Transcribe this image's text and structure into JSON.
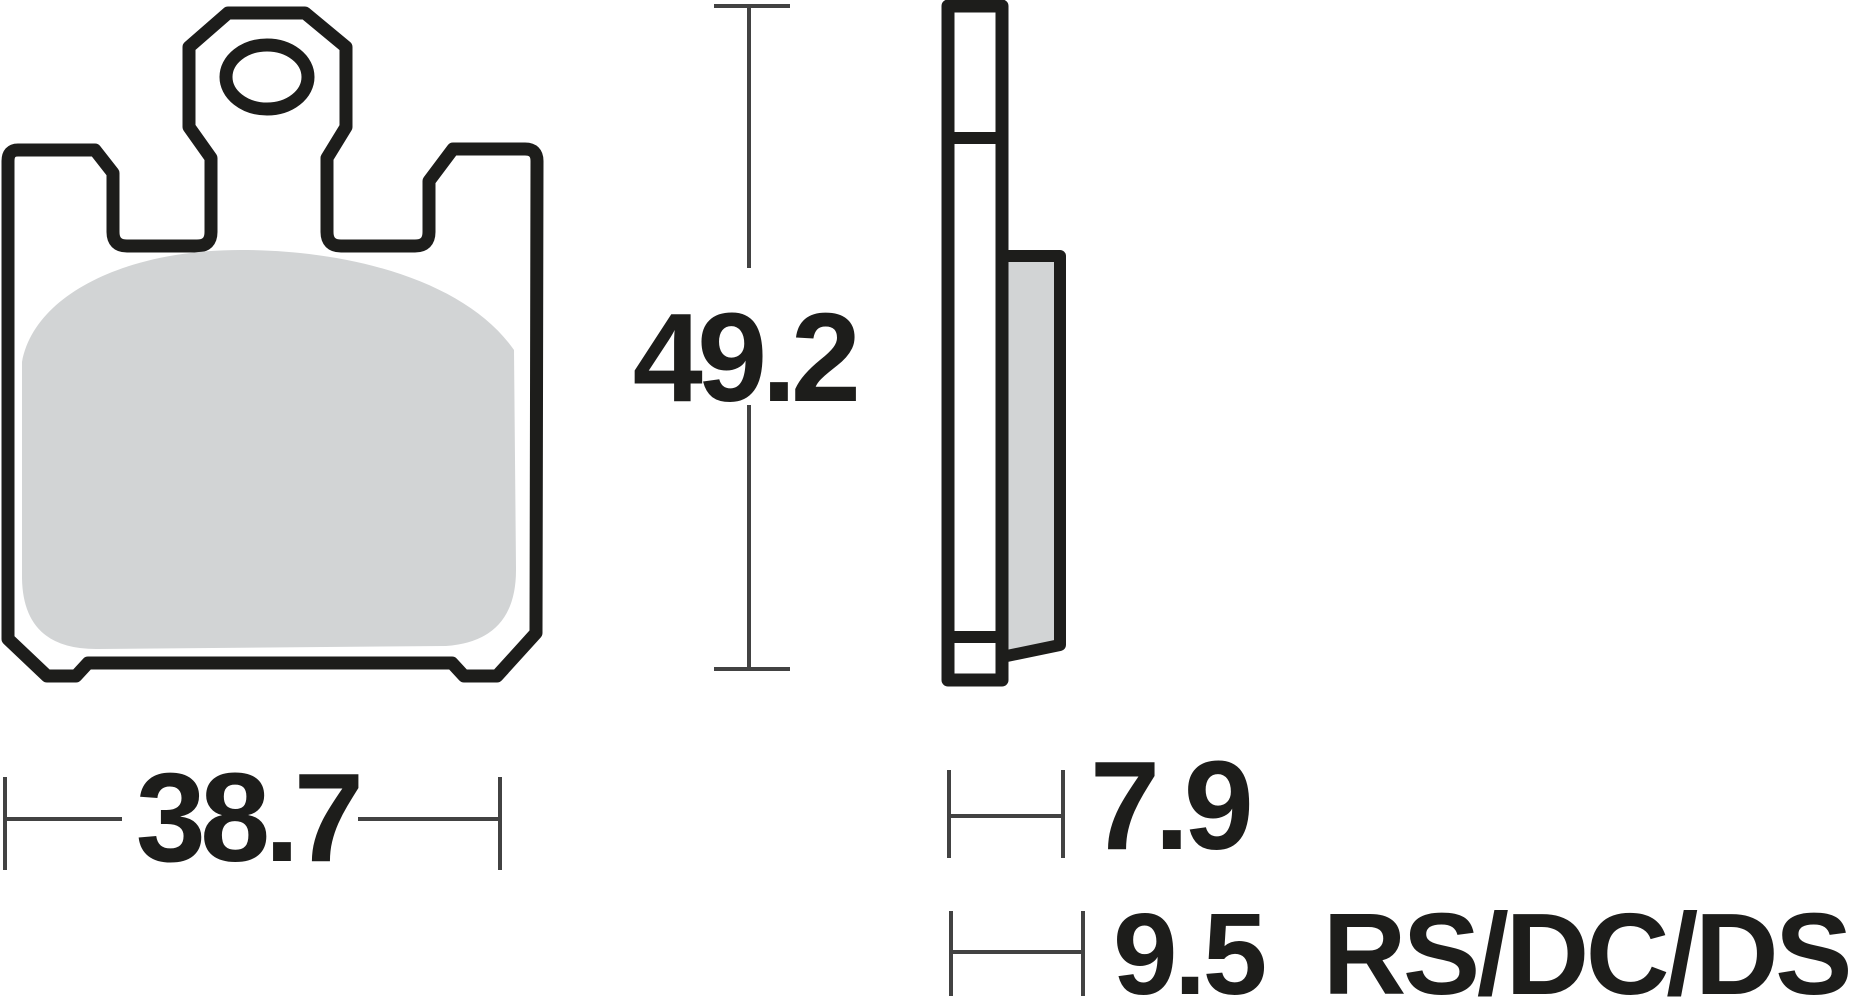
{
  "drawing": {
    "title": "brake-pad-technical-drawing",
    "colors": {
      "outline": "#1d1d1b",
      "dimension_line": "#424242",
      "friction_material": "#d2d4d5",
      "plate_fill": "#ffffff",
      "background": "#ffffff"
    },
    "views": {
      "front": {
        "name": "front-view"
      },
      "side": {
        "name": "side-view"
      }
    },
    "dimensions": {
      "height": {
        "value": "49.2",
        "orientation": "vertical"
      },
      "width": {
        "value": "38.7",
        "orientation": "horizontal"
      },
      "thickness_standard": {
        "value": "7.9",
        "orientation": "horizontal"
      },
      "thickness_alt": {
        "value": "9.5",
        "suffix": "RS/DC/DS",
        "orientation": "horizontal"
      }
    }
  }
}
